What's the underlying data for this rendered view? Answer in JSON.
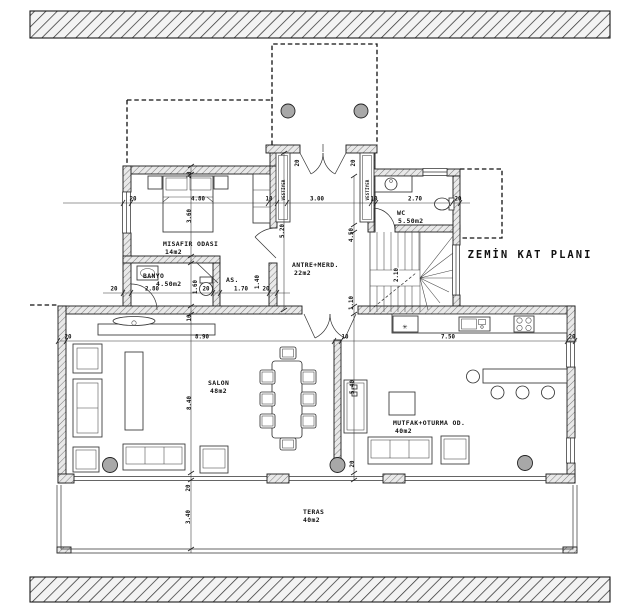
{
  "title": "ZEMİN KAT PLANI",
  "rooms": {
    "misafir": {
      "name": "MISAFIR ODASI",
      "area": "14m2"
    },
    "banyo": {
      "name": "BANYO",
      "area": "4.50m2"
    },
    "as": {
      "name": "AS."
    },
    "antre": {
      "name": "ANTRE+MERD.",
      "area": "22m2"
    },
    "wc": {
      "name": "WC",
      "area": "5.50m2"
    },
    "salon": {
      "name": "SALON",
      "area": "48m2"
    },
    "mutfak": {
      "name": "MUTFAK+OTURMA OD.",
      "area": "40m2"
    },
    "teras": {
      "name": "TERAS",
      "area": "40m2"
    }
  },
  "closet_label": "VESTİYER",
  "icons": {
    "fridge_snowflake": "✳"
  },
  "dims": {
    "w20": "20",
    "w10": "10",
    "h480": "4.80",
    "h300": "3.00",
    "h270": "2.70",
    "h280": "2.80",
    "h170": "1.70",
    "h890": "8.90",
    "h750": "7.50",
    "v360": "3.60",
    "v520": "5.20",
    "v450": "4.50",
    "v110": "1.10",
    "v160": "1.60",
    "v140": "1.40",
    "v210": "2.10",
    "v840": "8.40",
    "v540": "5.40",
    "v340": "3.40"
  },
  "colors": {
    "line": "#1a1a1a",
    "column_fill": "#a8a8a8"
  }
}
